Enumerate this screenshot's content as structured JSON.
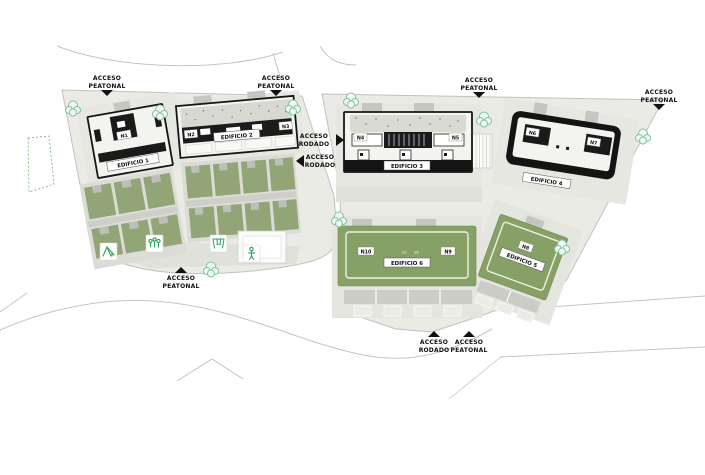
{
  "plan_type": "residential site plan",
  "access": [
    {
      "id": "top-left-pedestrian",
      "line1": "ACCESO",
      "line2": "PEATONAL",
      "arrow": "down"
    },
    {
      "id": "top-center-pedestrian",
      "line1": "ACCESO",
      "line2": "PEATONAL",
      "arrow": "down"
    },
    {
      "id": "top-mid-right-pedestrian",
      "line1": "ACCESO",
      "line2": "PEATONAL",
      "arrow": "down"
    },
    {
      "id": "far-right-pedestrian",
      "line1": "ACCESO",
      "line2": "PEATONAL",
      "arrow": "down"
    },
    {
      "id": "mid-road-east",
      "line1": "ACCESO",
      "line2": "RODADO",
      "arrow": "right"
    },
    {
      "id": "mid-road-west",
      "line1": "ACCESO",
      "line2": "RODADO",
      "arrow": "left"
    },
    {
      "id": "bottom-left-pedestrian",
      "line1": "ACCESO",
      "line2": "PEATONAL",
      "arrow": "up"
    },
    {
      "id": "bottom-road",
      "line1": "ACCESO",
      "line2": "RODADO",
      "arrow": "up"
    },
    {
      "id": "bottom-pedestrian",
      "line1": "ACCESO",
      "line2": "PEATONAL",
      "arrow": "up"
    }
  ],
  "buildings": [
    {
      "label": "EDIFICIO 1",
      "units": [
        "N1"
      ]
    },
    {
      "label": "EDIFICIO 2",
      "units": [
        "N2",
        "N3"
      ]
    },
    {
      "label": "EDIFICIO 3",
      "units": [
        "N4",
        "N5"
      ]
    },
    {
      "label": "EDIFICIO 4",
      "units": [
        "N6",
        "N7"
      ]
    },
    {
      "label": "EDIFICIO 5",
      "units": [
        "N8"
      ]
    },
    {
      "label": "EDIFICIO 6",
      "units": [
        "N10",
        "N9"
      ]
    }
  ],
  "icons": [
    "tree-icon",
    "playground-icon",
    "people-icon",
    "swing-icon",
    "person-icon",
    "access-arrow-icon"
  ],
  "colors": {
    "parcel": "#ebebe6",
    "building_pad": "#e7e7e1",
    "garden_green": "#92a577",
    "court_green": "#87a066",
    "building_dark": "#1a1a1a",
    "tree_green": "#7cc49b",
    "amenity_green": "#2f9e62",
    "road_gray": "#c5c5c0"
  }
}
